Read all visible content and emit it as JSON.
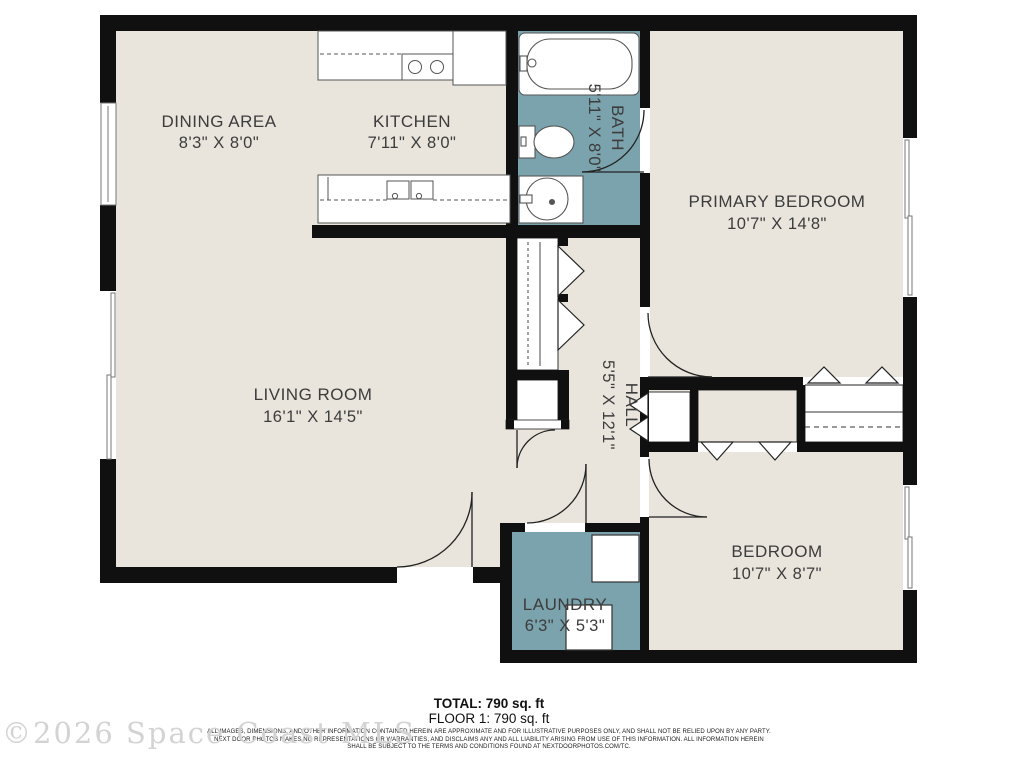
{
  "floorplan": {
    "rooms": [
      {
        "id": "dining",
        "name": "DINING AREA",
        "dims": "8'3\" X 8'0\""
      },
      {
        "id": "kitchen",
        "name": "KITCHEN",
        "dims": "7'11\" X 8'0\""
      },
      {
        "id": "bath",
        "name": "BATH",
        "dims": "5'11\" X 8'0\""
      },
      {
        "id": "primary",
        "name": "PRIMARY BEDROOM",
        "dims": "10'7\" X 14'8\""
      },
      {
        "id": "living",
        "name": "LIVING ROOM",
        "dims": "16'1\" X 14'5\""
      },
      {
        "id": "hall",
        "name": "HALL",
        "dims": "5'5\" X 12'1\""
      },
      {
        "id": "bedroom",
        "name": "BEDROOM",
        "dims": "10'7\" X 8'7\""
      },
      {
        "id": "laundry",
        "name": "LAUNDRY",
        "dims": "6'3\" X 5'3\""
      }
    ],
    "colors": {
      "floor": "#e9e5dc",
      "wet_floor": "#7ba3ad",
      "wall": "#101010",
      "fixture_line": "#555555",
      "label_text": "#3c3c3c"
    }
  },
  "footer": {
    "total": "TOTAL: 790 sq. ft",
    "floor1": "FLOOR 1: 790 sq. ft",
    "disclaimer_line1": "ALL IMAGES, DIMENSIONS, AND OTHER INFORMATION CONTAINED HEREIN ARE APPROXIMATE AND FOR ILLUSTRATIVE PURPOSES ONLY, AND SHALL NOT BE RELIED UPON BY ANY PARTY.",
    "disclaimer_line2": "NEXT DOOR PHOTOS MAKES NO REPRESENTATIONS OR WARRANTIES, AND DISCLAIMS ANY AND ALL LIABILITY ARISING FROM USE OF THIS INFORMATION. ALL INFORMATION HEREIN",
    "disclaimer_line3": "SHALL BE SUBJECT TO THE TERMS AND CONDITIONS FOUND AT NEXTDOORPHOTOS.COM/TC."
  },
  "watermark": "©2026 Space Coast MLS"
}
